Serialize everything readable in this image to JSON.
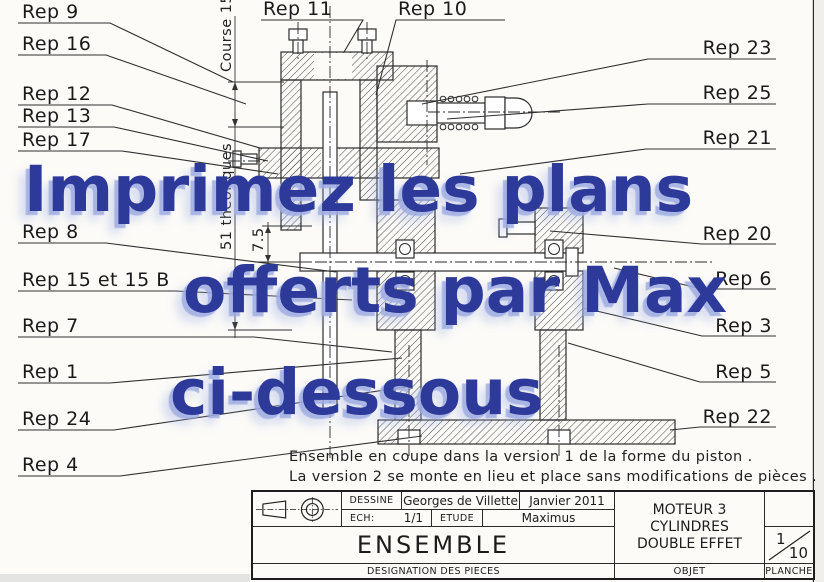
{
  "watermark": {
    "line1": "Imprimez les plans",
    "line2": "offerts par Max",
    "line3": "ci-dessous",
    "color": "#2d3a9a"
  },
  "callouts": {
    "top": [
      "Rep 11",
      "Rep 10"
    ],
    "left": [
      "Rep 9",
      "Rep 16",
      "Rep 12",
      "Rep 13",
      "Rep 17",
      "Rep 8",
      "Rep 15 et 15 B",
      "Rep 7",
      "Rep 1",
      "Rep 24",
      "Rep 4"
    ],
    "right": [
      "Rep 23",
      "Rep 25",
      "Rep 21",
      "Rep 20",
      "Rep 6",
      "Rep 3",
      "Rep 5",
      "Rep 22"
    ]
  },
  "dimensions": {
    "course": "Course 15",
    "theoriques": "51 théoriques",
    "offset": "7.5"
  },
  "caption": {
    "line1": "Ensemble en coupe dans la version 1 de la forme du piston .",
    "line2": "La version 2 se monte en lieu et place sans modifications de pièces ."
  },
  "title_block": {
    "dessine_label": "DESSINE",
    "dessine_value": "Georges de Villette",
    "date": "Janvier 2011",
    "ech_label": "ECH:",
    "ech_value": "1/1",
    "etude_label": "ETUDE",
    "etude_value": "Maximus",
    "assembly_title": "ENSEMBLE",
    "designation_label": "DESIGNATION DES PIECES",
    "object_line1": "MOTEUR 3",
    "object_line2": "CYLINDRES",
    "object_line3": "DOUBLE EFFET",
    "objet_label": "OBJET",
    "planche_label": "PLANCHE",
    "sheet_number": "1",
    "sheet_total": "10"
  }
}
